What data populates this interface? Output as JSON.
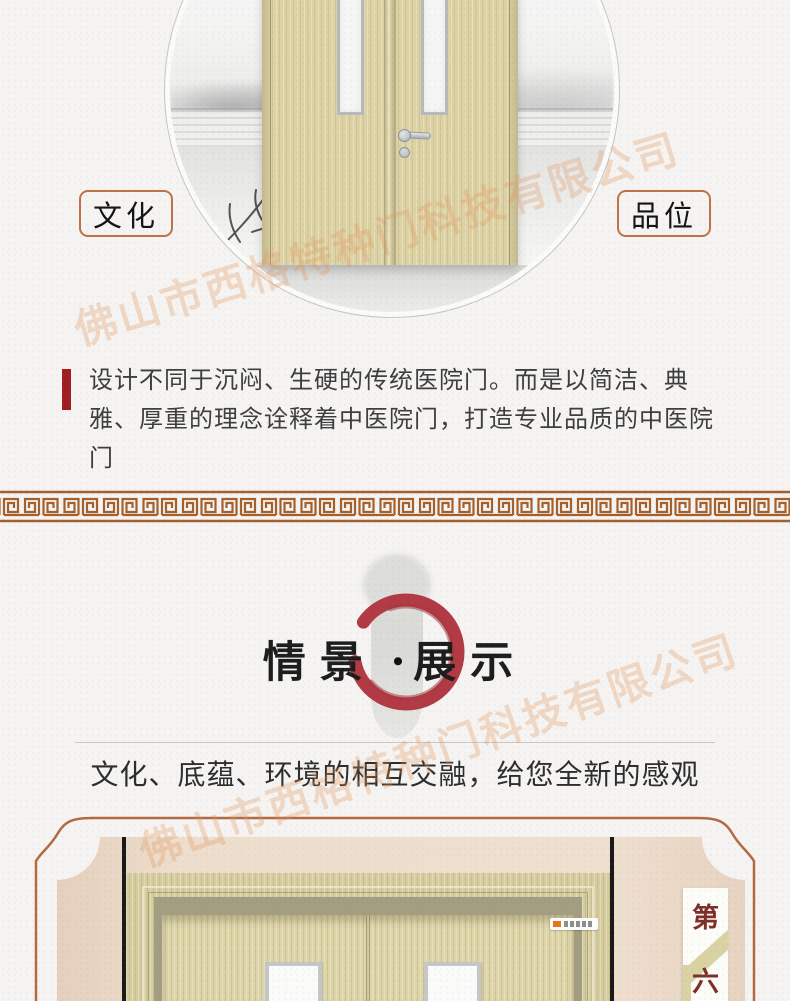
{
  "page": {
    "background": "#f5f4f2"
  },
  "watermark": {
    "text": "佛山市西格特种门科技有限公司",
    "color": "#e1965a"
  },
  "hero": {
    "tag_left": "文化",
    "tag_right": "品位",
    "tag_border_color": "#bf7248",
    "accent_bar_color": "#a01d22",
    "description": "设计不同于沉闷、生硬的传统医院门。而是以简洁、典雅、厚重的理念诠释着中医院门，打造专业品质的中医院门"
  },
  "divider": {
    "style": "greek-key-meander",
    "color": "#a3602c"
  },
  "showcase": {
    "title_left": "情景",
    "title_dot": "•",
    "title_right": "展示",
    "enso_color": "#b23a45",
    "subtitle": "文化、底蕴、环境的相互交融，给您全新的感观"
  },
  "scene": {
    "frame_color": "#b26a42",
    "badge_top": "第",
    "badge_bottom": "六",
    "badge_text_color": "#7d2f28"
  }
}
